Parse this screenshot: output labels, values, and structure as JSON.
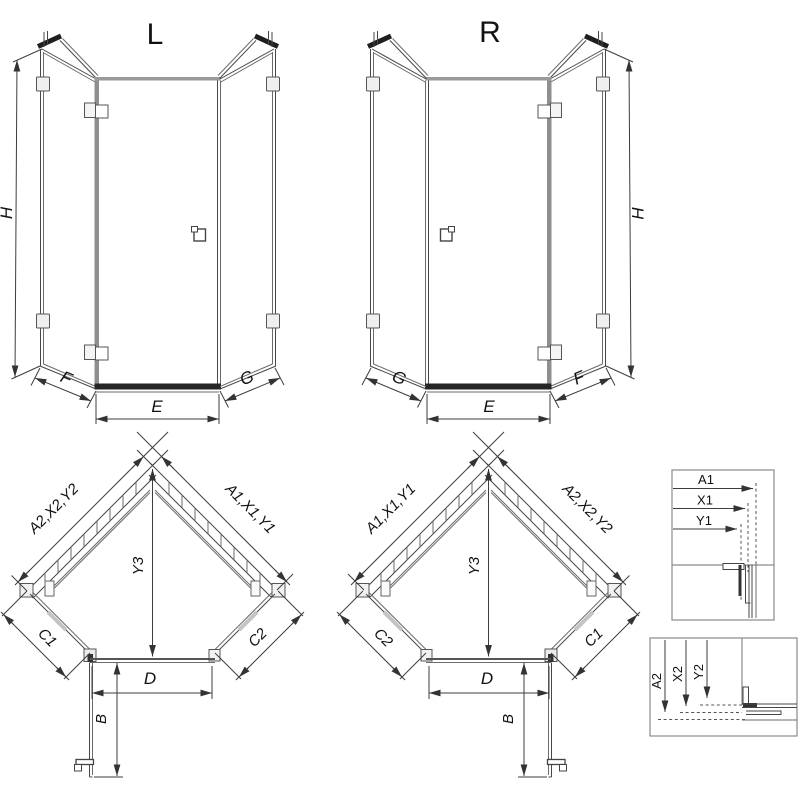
{
  "figure": {
    "type": "technical-drawing",
    "subject": "pentagonal corner shower enclosure dimension diagram"
  },
  "elevation_left": {
    "title": "L",
    "height": "H",
    "side_left": "F",
    "door_width": "E",
    "side_right": "G"
  },
  "elevation_right": {
    "title": "R",
    "height": "H",
    "side_left": "G",
    "door_width": "E",
    "side_right": "F"
  },
  "plan_left": {
    "wall_left": "A2,X2,Y2",
    "wall_right": "A1,X1,Y1",
    "diagonal_depth": "Y3",
    "side_left": "C1",
    "side_right": "C2",
    "front_width": "D",
    "door_depth": "B"
  },
  "plan_right": {
    "wall_left": "A1,X1,Y1",
    "wall_right": "A2,X2,Y2",
    "diagonal_depth": "Y3",
    "side_left": "C2",
    "side_right": "C1",
    "front_width": "D",
    "door_depth": "B"
  },
  "detail_top": {
    "labels": [
      "A1",
      "X1",
      "Y1"
    ]
  },
  "detail_bottom": {
    "labels": [
      "A2",
      "X2",
      "Y2"
    ]
  },
  "colors": {
    "line": "#474747",
    "dark": "#1f1f1f",
    "profile_gray": "#8f8f8f",
    "bracket_fill": "#efefef",
    "detail_border": "#8a8a8a",
    "background": "#ffffff"
  }
}
